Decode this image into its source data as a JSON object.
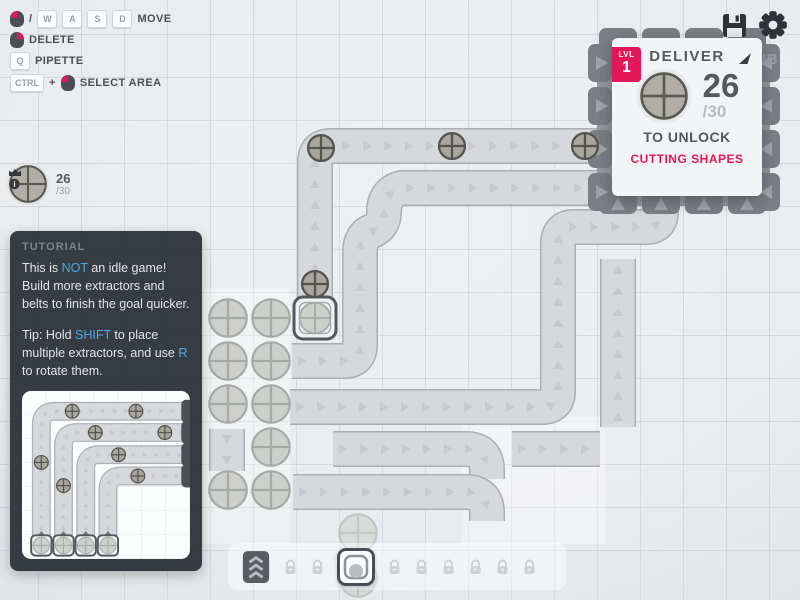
{
  "hints": {
    "slash": "/",
    "plus": "+",
    "keys": {
      "w": "W",
      "a": "A",
      "s": "S",
      "d": "D",
      "q": "Q",
      "ctrl": "CTRL"
    },
    "labels": {
      "move": "MOVE",
      "delete": "DELETE",
      "pipette": "PIPETTE",
      "select_area": "SELECT AREA"
    }
  },
  "pinned": {
    "shape": "circle-shape",
    "amount": "26",
    "total": "/30"
  },
  "hub_panel": {
    "level_label": "LVL",
    "level": "1",
    "title": "DELIVER",
    "goal_shape": "circle-shape",
    "amount": "26",
    "total": "/30",
    "unlock_text": "TO UNLOCK",
    "reward": "CUTTING SHAPES",
    "hub_label": "HUB"
  },
  "tutorial": {
    "title": "TUTORIAL",
    "p1": [
      {
        "t": "This is "
      },
      {
        "t": "NOT",
        "hl": true
      },
      {
        "t": " an idle game! Build more extractors and belts to finish the goal quicker."
      }
    ],
    "p2": [
      {
        "t": "Tip: Hold "
      },
      {
        "t": "SHIFT",
        "hl": true
      },
      {
        "t": " to place multiple extractors, and use "
      },
      {
        "t": "R",
        "hl": true
      },
      {
        "t": " to rotate them."
      }
    ]
  },
  "topbar": {
    "icons": [
      "save-icon",
      "settings-icon"
    ]
  },
  "toolbar": {
    "items": [
      {
        "name": "belt",
        "state": "unlocked"
      },
      {
        "name": "locked-slot"
      },
      {
        "name": "locked-slot"
      },
      {
        "name": "extractor",
        "state": "selected"
      },
      {
        "name": "locked-slot"
      },
      {
        "name": "locked-slot"
      },
      {
        "name": "locked-slot"
      },
      {
        "name": "locked-slot"
      },
      {
        "name": "locked-slot"
      },
      {
        "name": "locked-slot"
      }
    ]
  },
  "colors": {
    "accent": "#e5175b",
    "highlight": "#4fa8dd",
    "belt": "#d6d8db",
    "background": "#e9ebee"
  }
}
